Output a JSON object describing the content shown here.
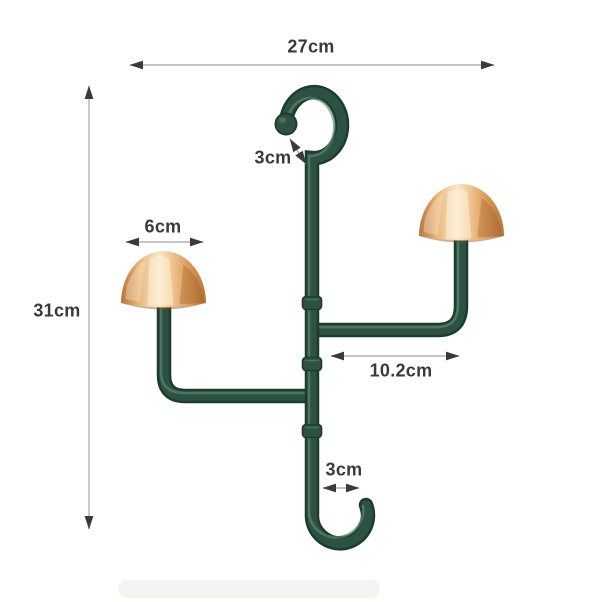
{
  "diagram": {
    "dimensions": {
      "overall_width": "27cm",
      "overall_height": "31cm",
      "top_hook_opening": "3cm",
      "knob_diameter": "6cm",
      "arm_length": "10.2cm",
      "bottom_hook_opening": "3cm"
    },
    "colors": {
      "background": "#ffffff",
      "tube-dark": "#1e3b2f",
      "tube-mid": "#2d5242",
      "tube-highlight": "#5d8a72",
      "gold-deep": "#b5763c",
      "gold-mid": "#e9b87e",
      "gold-light": "#f9e7c8",
      "dim-line": "#b3b3b3",
      "dim-arrow": "#3a3a3a",
      "dim-text": "#3a3a3a"
    }
  }
}
